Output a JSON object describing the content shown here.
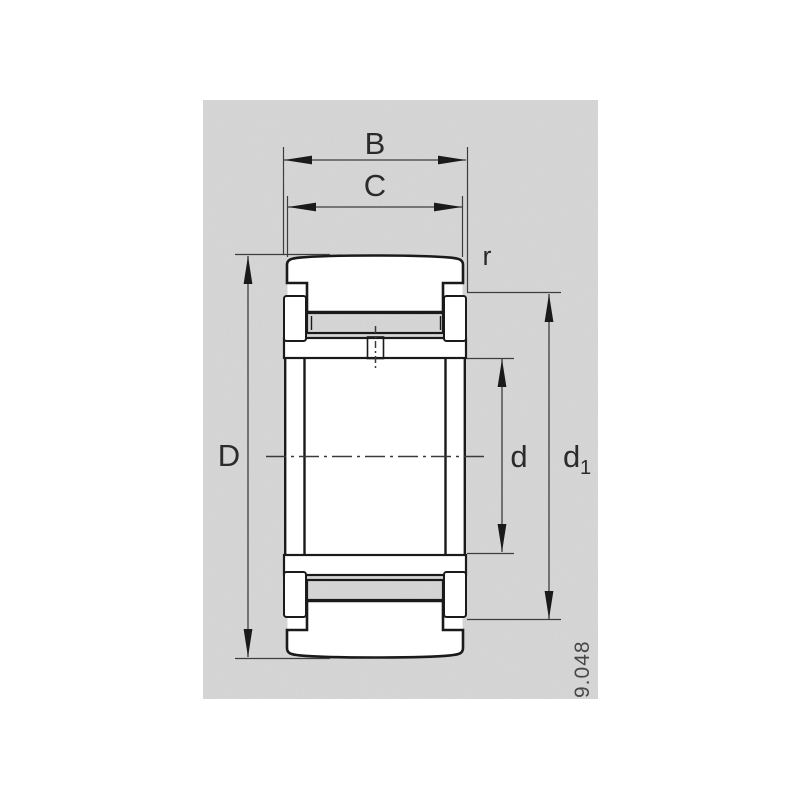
{
  "drawing": {
    "dimension_labels": {
      "B": "B",
      "C": "C",
      "D": "D",
      "d": "d",
      "d1_base": "d",
      "d1_sub": "1",
      "r": "r"
    },
    "figure_number": "9.048",
    "colors": {
      "panel_gray": "#d6d6d6",
      "ink": "#1a1a1a",
      "dim_line": "#3d3d3d",
      "label_text": "#2b2b2b",
      "bore_white": "#ffffff"
    }
  }
}
